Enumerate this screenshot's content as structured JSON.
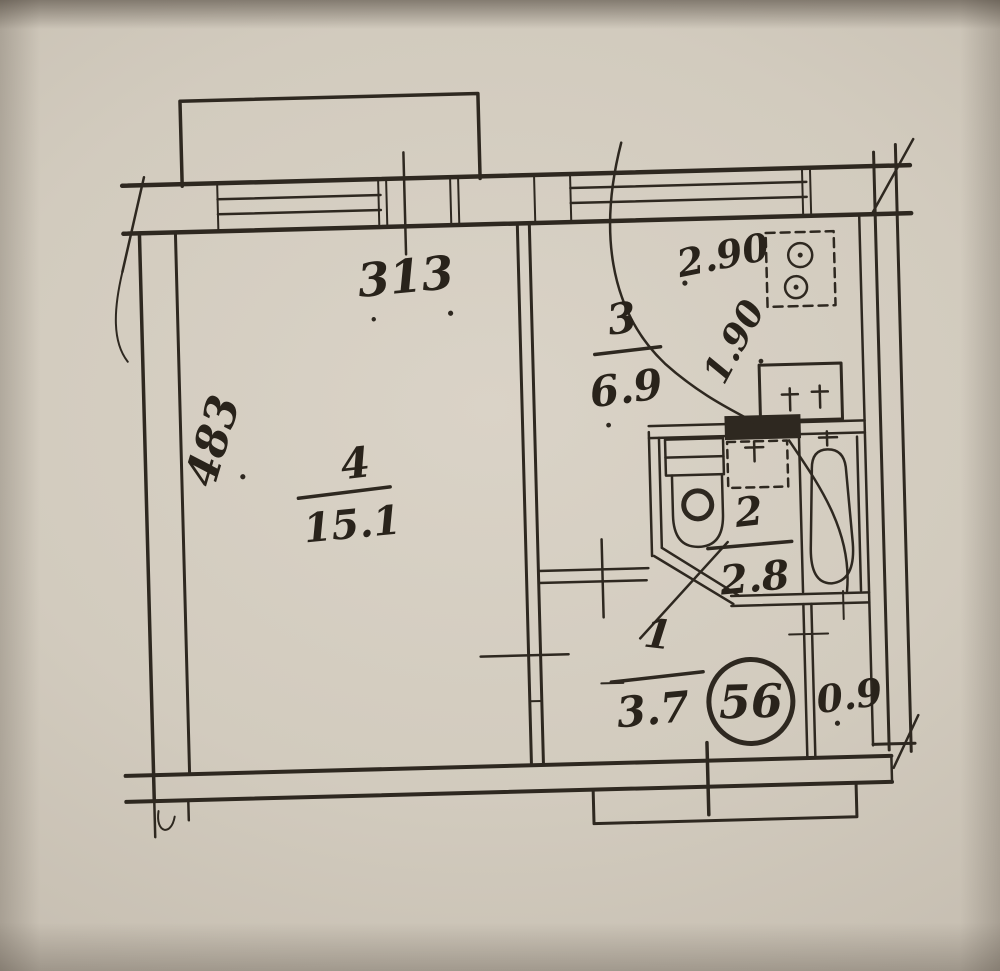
{
  "document": {
    "type": "apartment floor plan (hand-drawn blueprint)",
    "apartment_number": "56"
  },
  "rooms": [
    {
      "name": "living-room",
      "number": "4",
      "area": "15.1"
    },
    {
      "name": "kitchen",
      "number": "3",
      "area": "6.9"
    },
    {
      "name": "bathroom",
      "number": "2",
      "area": "2.8"
    },
    {
      "name": "hallway",
      "number": "1",
      "area": "3.7"
    },
    {
      "name": "closet",
      "area": "0.9"
    }
  ],
  "dimensions": {
    "window_wall_width": "313",
    "room_depth": "483",
    "kitchen_width": "2.90",
    "kitchen_wall": "1.90"
  },
  "fixtures": [
    "balcony",
    "living-room-window",
    "kitchen-window",
    "stove",
    "kitchen-sink",
    "vent-shaft",
    "toilet",
    "washbasin",
    "bathtub",
    "entrance-door",
    "closet"
  ],
  "colors": {
    "ink": "#2e2820",
    "paper": "#d2cbbe"
  }
}
